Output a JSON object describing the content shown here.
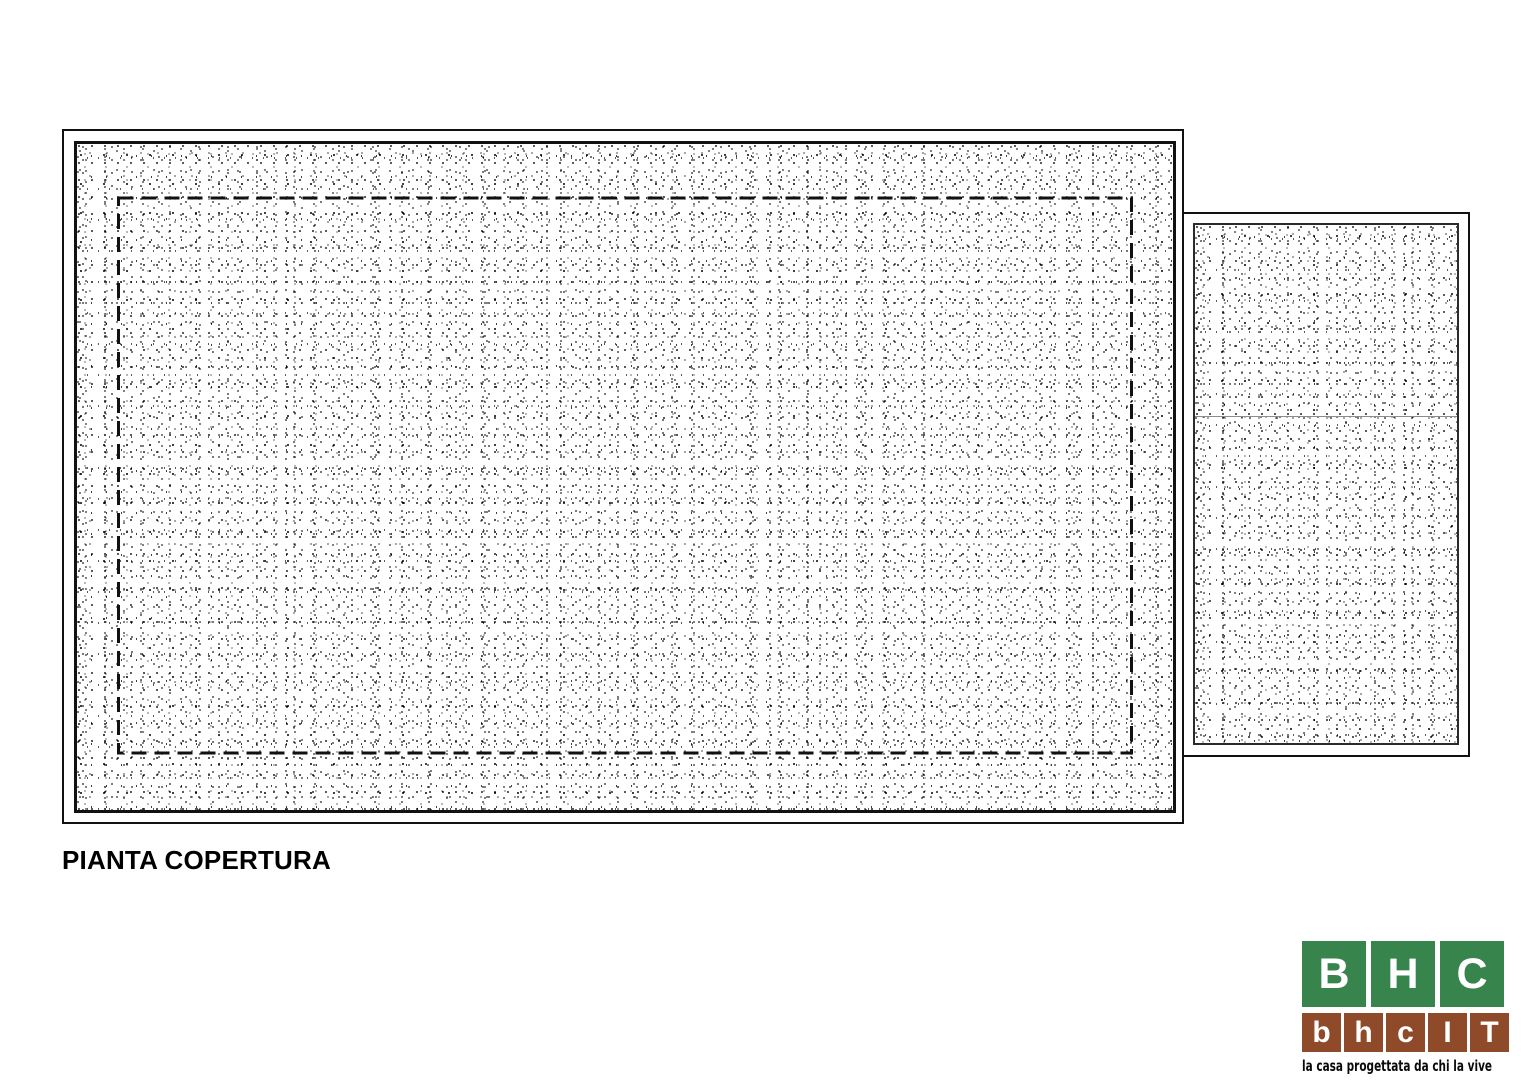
{
  "title": "PIANTA COPERTURA",
  "drawing": {
    "main_roof": "hatched roof surface with dashed wall-perimeter outline",
    "annex_roof": "hatched annex roof surface with ridge line"
  },
  "logo": {
    "top_row": [
      "B",
      "H",
      "C"
    ],
    "bottom_row": [
      "b",
      "h",
      "c",
      "I",
      "T"
    ],
    "tagline": "la casa progettata da chi la vive",
    "green": "#37854c",
    "brown": "#8e4a29"
  }
}
